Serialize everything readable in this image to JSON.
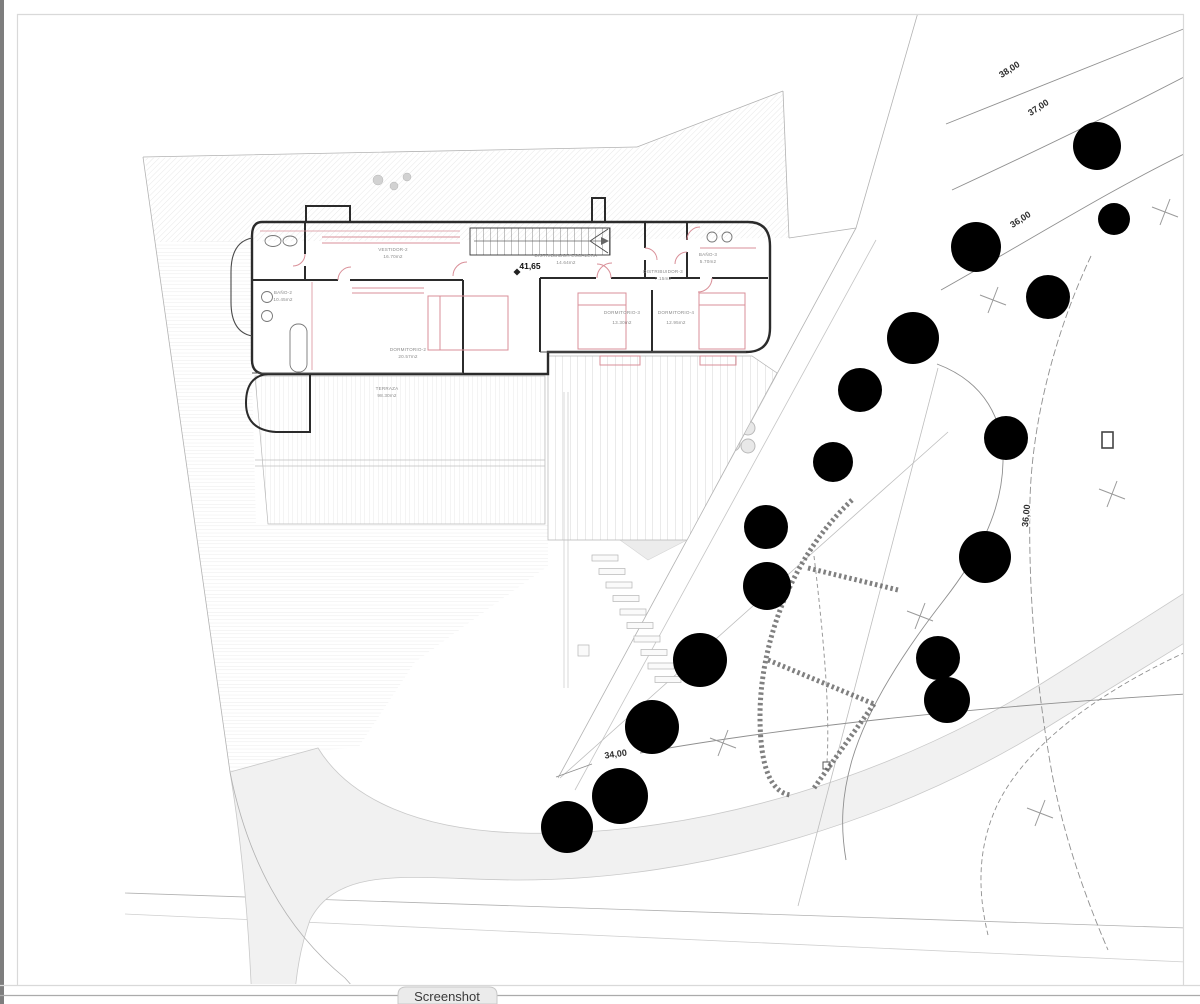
{
  "window": {
    "tab_label": "Screenshot"
  },
  "plan": {
    "level_marker": "41,65",
    "rooms": [
      {
        "name": "VESTIDOR-2",
        "area": "16.70m2"
      },
      {
        "name": "BAÑO-2",
        "area": "10.45m2"
      },
      {
        "name": "DORMITORIO-2",
        "area": "20.57m2"
      },
      {
        "name": "TERRAZA",
        "area": "98.30m2"
      },
      {
        "name": "DISTRIBUIDOR ESCALERA",
        "area": "14.64m2"
      },
      {
        "name": "DISTRIBUIDOR-3",
        "area": "7.15m2"
      },
      {
        "name": "BAÑO-3",
        "area": "5.70m2"
      },
      {
        "name": "DORMITORIO-3",
        "area": "13.30m2"
      },
      {
        "name": "DORMITORIO-4",
        "area": "12.95m2"
      }
    ],
    "contour_labels": [
      {
        "text": "38,00"
      },
      {
        "text": "37,00"
      },
      {
        "text": "36,00"
      },
      {
        "text": "36,00"
      },
      {
        "text": "34,00"
      }
    ],
    "colors": {
      "tree_green": "#5cbf4e",
      "furniture_pink": "#d98f98",
      "wall_dark": "#2b2b2b",
      "contour_gray": "#8f8f8f"
    }
  }
}
